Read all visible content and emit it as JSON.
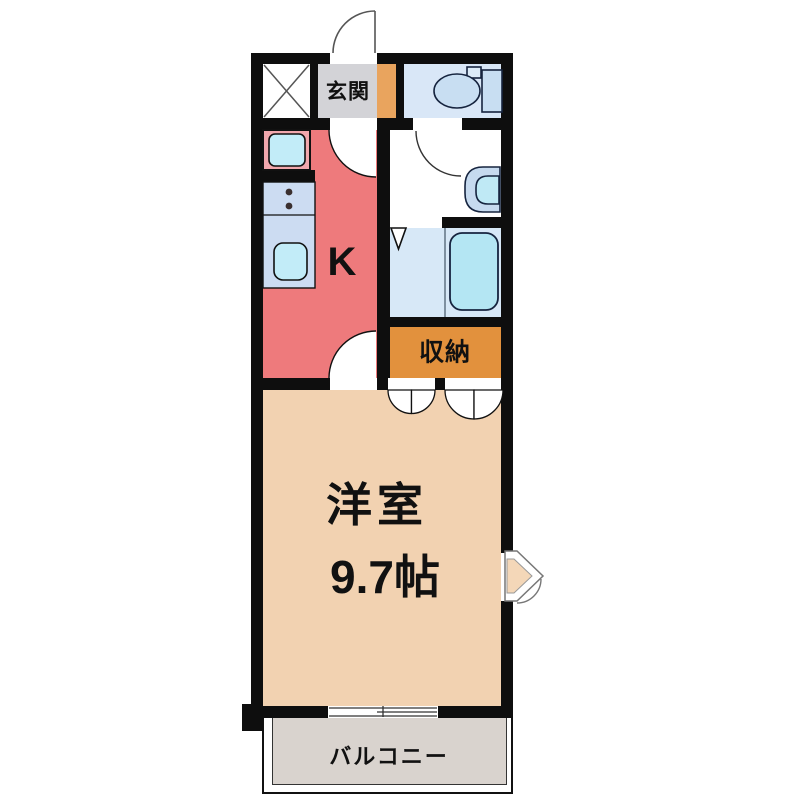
{
  "floor_plan": {
    "type": "japanese-apartment-1K-madori",
    "rooms": {
      "entrance": {
        "label": "玄関"
      },
      "kitchen": {
        "label": "K"
      },
      "storage": {
        "label": "収納"
      },
      "western_room": {
        "label": "洋室",
        "size": "9.7帖"
      },
      "balcony": {
        "label": "バルコニー"
      }
    },
    "fixtures": [
      "toilet",
      "wash-basin",
      "bathtub",
      "washing-machine-pan",
      "kitchen-sink",
      "stove",
      "entrance-door",
      "sliding-window",
      "closet-double-doors",
      "folding-bath-door",
      "shaft-x-box"
    ],
    "colors": {
      "wall": "#0e0e0e",
      "kitchen": "#ee7a7c",
      "entrance_floor": "#d3d3d7",
      "entrance_step": "#e9a45e",
      "toilet_room": "#d9e7f7",
      "bathroom": "#d7e8f7",
      "storage": "#e2913d",
      "western_room": "#f2d2b1",
      "balcony": "#d9d3ce",
      "fixture_blue": "#c8def2",
      "sink_cyan": "#c2ecf8",
      "counter_blue": "#ccdcf2",
      "washer_pan_pink": "#f1a7ad"
    }
  }
}
